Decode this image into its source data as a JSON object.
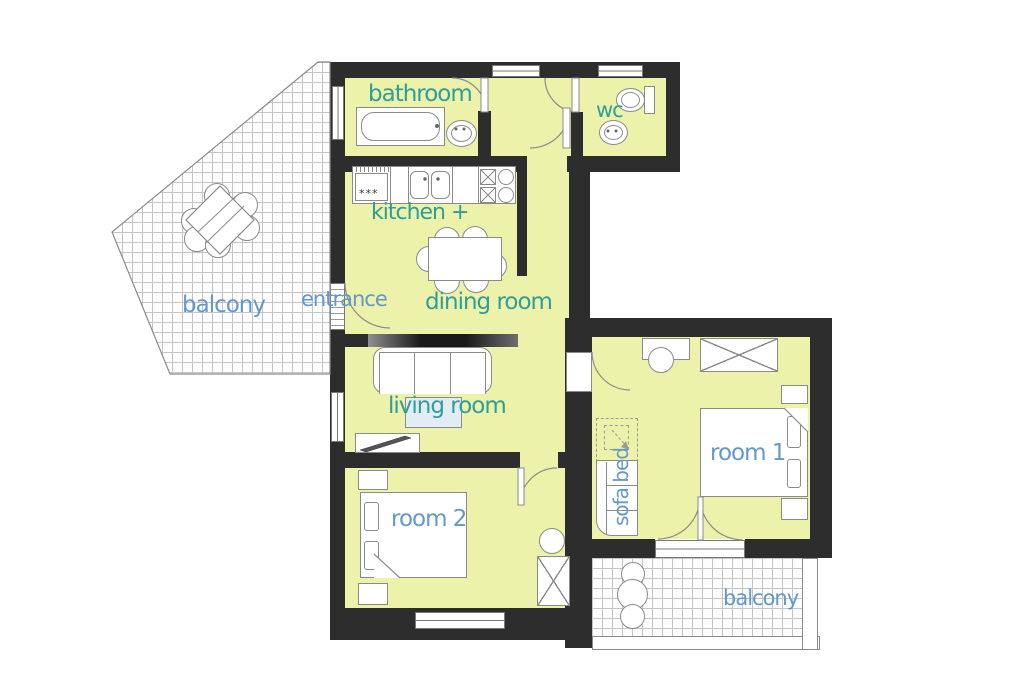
{
  "plan": {
    "labels": {
      "bathroom": "bathroom",
      "wc": "wc",
      "kitchen": "kitchen +",
      "dining": "dining room",
      "entrance": "entrance",
      "balcony_left": "balcony",
      "living": "living room",
      "room1": "room 1",
      "room2": "room 2",
      "sofa_bed": "sofa bed",
      "balcony_bottom": "balcony"
    },
    "fridge_marking": "***",
    "colors": {
      "floor": "#edf2ab",
      "wall": "#2d2d2d",
      "label_teal": "#2f9e9b",
      "label_blue": "#6298cc",
      "furniture_stroke": "#8a8a8a",
      "tile_line": "#c4c4c4"
    },
    "furniture": [
      "bathtub",
      "washbasin",
      "toilet",
      "kitchen-counter",
      "fridge",
      "kitchen-sink",
      "stove",
      "dining-table",
      "dining-chair",
      "sofa",
      "coffee-table",
      "tv-unit",
      "double-bed",
      "pillow",
      "wardrobe",
      "desk",
      "desk-chair",
      "nightstand",
      "sofa-bed",
      "stool",
      "balcony-table",
      "balcony-chair"
    ]
  }
}
